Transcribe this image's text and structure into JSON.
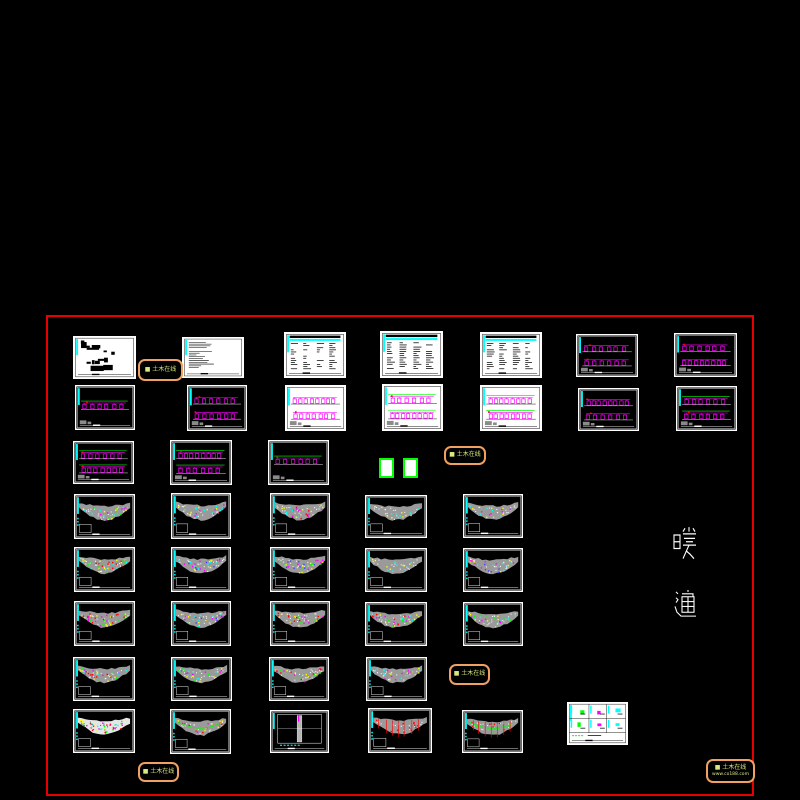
{
  "canvas": {
    "background_color": "#000000",
    "frame": {
      "x": 46,
      "y": 315,
      "w": 708,
      "h": 481,
      "color": "#e60000"
    },
    "hvac_label": {
      "text": "暖通",
      "chars": [
        {
          "ch": "暖",
          "x": 673,
          "y": 526,
          "w": 24,
          "h": 36
        },
        {
          "ch": "通",
          "x": 673,
          "y": 589,
          "w": 24,
          "h": 31
        }
      ],
      "color": "#ffffff"
    },
    "watermarks": [
      {
        "x": 138,
        "y": 359,
        "w": 45,
        "h": 22,
        "lines": [
          "■ 土木在线"
        ]
      },
      {
        "x": 444,
        "y": 446,
        "w": 42,
        "h": 19,
        "lines": [
          "■ 土木在线"
        ]
      },
      {
        "x": 449,
        "y": 664,
        "w": 41,
        "h": 21,
        "lines": [
          "■ 土木在线"
        ]
      },
      {
        "x": 138,
        "y": 762,
        "w": 41,
        "h": 20,
        "lines": [
          "■ 土木在线"
        ]
      },
      {
        "x": 706,
        "y": 759,
        "w": 49,
        "h": 24,
        "lines": [
          "■ 土木在线",
          "www.co188.com"
        ]
      }
    ],
    "green_boxes": [
      {
        "x": 379,
        "y": 458,
        "w": 15,
        "h": 20
      },
      {
        "x": 403,
        "y": 458,
        "w": 15,
        "h": 20
      }
    ],
    "palette": {
      "cyan": "#00ffff",
      "magenta": "#ff00ff",
      "green": "#00ff00",
      "yellow": "#ffff00",
      "red": "#ff0000",
      "blue": "#4040ff",
      "white": "#ffffff",
      "gray_building": "#9a9a9a",
      "stamp_text": "#d9e87f",
      "stamp_border": "#f0a060"
    },
    "sheets": [
      {
        "id": "r1c1",
        "x": 73,
        "y": 336,
        "w": 63,
        "h": 43,
        "kind": "cover",
        "bg": "white",
        "accents": []
      },
      {
        "id": "r1c2",
        "x": 182,
        "y": 337,
        "w": 62,
        "h": 41,
        "kind": "notes",
        "bg": "white",
        "accents": []
      },
      {
        "id": "r1c3",
        "x": 284,
        "y": 332,
        "w": 62,
        "h": 46,
        "kind": "table",
        "bg": "white",
        "accents": []
      },
      {
        "id": "r1c4",
        "x": 380,
        "y": 331,
        "w": 63,
        "h": 47,
        "kind": "table",
        "bg": "white",
        "accents": []
      },
      {
        "id": "r1c5",
        "x": 480,
        "y": 332,
        "w": 62,
        "h": 46,
        "kind": "table",
        "bg": "white",
        "accents": []
      },
      {
        "id": "r1c6",
        "x": 576,
        "y": 334,
        "w": 62,
        "h": 43,
        "kind": "system",
        "bg": "black",
        "accents": [
          "#ff00ff"
        ],
        "bands": 2
      },
      {
        "id": "r1c7",
        "x": 674,
        "y": 333,
        "w": 63,
        "h": 44,
        "kind": "system",
        "bg": "black",
        "accents": [
          "#ff00ff"
        ],
        "bands": 2
      },
      {
        "id": "r2c1",
        "x": 75,
        "y": 385,
        "w": 60,
        "h": 45,
        "kind": "system",
        "bg": "black",
        "accents": [
          "#ff00ff",
          "#00ff00"
        ],
        "bands": 1
      },
      {
        "id": "r2c2",
        "x": 187,
        "y": 385,
        "w": 60,
        "h": 46,
        "kind": "system",
        "bg": "black",
        "accents": [
          "#ff00ff"
        ],
        "bands": 2
      },
      {
        "id": "r2c3",
        "x": 285,
        "y": 385,
        "w": 61,
        "h": 46,
        "kind": "system",
        "bg": "white",
        "accents": [
          "#ff00ff"
        ],
        "bands": 2
      },
      {
        "id": "r2c4",
        "x": 382,
        "y": 384,
        "w": 61,
        "h": 47,
        "kind": "system",
        "bg": "white",
        "accents": [
          "#ff00ff",
          "#00ff00"
        ],
        "bands": 2
      },
      {
        "id": "r2c5",
        "x": 480,
        "y": 385,
        "w": 62,
        "h": 46,
        "kind": "system",
        "bg": "white",
        "accents": [
          "#ff00ff",
          "#00ff00"
        ],
        "bands": 2
      },
      {
        "id": "r2c6",
        "x": 578,
        "y": 388,
        "w": 61,
        "h": 43,
        "kind": "system",
        "bg": "black",
        "accents": [
          "#ff00ff"
        ],
        "bands": 2
      },
      {
        "id": "r2c7",
        "x": 676,
        "y": 386,
        "w": 61,
        "h": 45,
        "kind": "system",
        "bg": "black",
        "accents": [
          "#ff00ff",
          "#00ff00"
        ],
        "bands": 2
      },
      {
        "id": "r3c1",
        "x": 73,
        "y": 441,
        "w": 61,
        "h": 43,
        "kind": "system",
        "bg": "black",
        "accents": [
          "#ff00ff",
          "#00ff00"
        ],
        "bands": 2
      },
      {
        "id": "r3c2",
        "x": 170,
        "y": 440,
        "w": 62,
        "h": 45,
        "kind": "system",
        "bg": "black",
        "accents": [
          "#ff00ff",
          "#00ff00"
        ],
        "bands": 2
      },
      {
        "id": "r3c3",
        "x": 268,
        "y": 440,
        "w": 61,
        "h": 45,
        "kind": "system",
        "bg": "black",
        "accents": [
          "#ff00ff",
          "#00ff00"
        ],
        "bands": 1
      },
      {
        "id": "r4c1",
        "x": 74,
        "y": 494,
        "w": 61,
        "h": 45,
        "kind": "plan",
        "bg": "black",
        "accents": [
          "#00ffff",
          "#ffff00",
          "#ff00ff",
          "#00ff00"
        ],
        "density": 30
      },
      {
        "id": "r4c2",
        "x": 171,
        "y": 493,
        "w": 60,
        "h": 46,
        "kind": "plan",
        "bg": "black",
        "accents": [
          "#00ffff",
          "#ff00ff",
          "#ffff00"
        ],
        "density": 25
      },
      {
        "id": "r4c3",
        "x": 270,
        "y": 493,
        "w": 60,
        "h": 46,
        "kind": "plan",
        "bg": "black",
        "accents": [
          "#ff00ff",
          "#ffff00",
          "#ff0000",
          "#00ffff"
        ],
        "density": 30
      },
      {
        "id": "r4c4",
        "x": 365,
        "y": 495,
        "w": 62,
        "h": 43,
        "kind": "plan",
        "bg": "black",
        "accents": [
          "#00ffff",
          "#ffff00"
        ],
        "density": 14
      },
      {
        "id": "r4c5",
        "x": 463,
        "y": 494,
        "w": 60,
        "h": 44,
        "kind": "plan",
        "bg": "black",
        "accents": [
          "#00ffff",
          "#ffff00",
          "#ff00ff"
        ],
        "density": 18
      },
      {
        "id": "r5c1",
        "x": 74,
        "y": 547,
        "w": 61,
        "h": 45,
        "kind": "plan",
        "bg": "black",
        "accents": [
          "#ffff00",
          "#00ff00",
          "#ff0000",
          "#00ffff"
        ],
        "density": 42
      },
      {
        "id": "r5c2",
        "x": 171,
        "y": 547,
        "w": 60,
        "h": 45,
        "kind": "plan",
        "bg": "black",
        "accents": [
          "#ff00ff",
          "#00ffff",
          "#ffff00",
          "#4040ff"
        ],
        "density": 30
      },
      {
        "id": "r5c3",
        "x": 270,
        "y": 547,
        "w": 60,
        "h": 45,
        "kind": "plan",
        "bg": "black",
        "accents": [
          "#ffff00",
          "#00ff00",
          "#ff00ff",
          "#4040ff"
        ],
        "density": 36
      },
      {
        "id": "r5c4",
        "x": 365,
        "y": 548,
        "w": 62,
        "h": 44,
        "kind": "plan",
        "bg": "black",
        "accents": [
          "#00ffff",
          "#ffff00"
        ],
        "density": 14
      },
      {
        "id": "r5c5",
        "x": 463,
        "y": 548,
        "w": 60,
        "h": 44,
        "kind": "plan",
        "bg": "black",
        "accents": [
          "#ff00ff",
          "#00ffff",
          "#4040ff",
          "#ffff00"
        ],
        "density": 26
      },
      {
        "id": "r6c1",
        "x": 74,
        "y": 601,
        "w": 61,
        "h": 45,
        "kind": "plan",
        "bg": "black",
        "accents": [
          "#ffff00",
          "#ff0000",
          "#00ff00",
          "#ff00ff"
        ],
        "density": 42
      },
      {
        "id": "r6c2",
        "x": 171,
        "y": 601,
        "w": 60,
        "h": 45,
        "kind": "plan",
        "bg": "black",
        "accents": [
          "#00ffff",
          "#ff00ff",
          "#ffff00",
          "#4040ff"
        ],
        "density": 30
      },
      {
        "id": "r6c3",
        "x": 270,
        "y": 601,
        "w": 60,
        "h": 45,
        "kind": "plan",
        "bg": "black",
        "accents": [
          "#ffff00",
          "#ff00ff",
          "#00ff00",
          "#ff0000"
        ],
        "density": 36
      },
      {
        "id": "r6c4",
        "x": 365,
        "y": 602,
        "w": 62,
        "h": 44,
        "kind": "plan",
        "bg": "black",
        "accents": [
          "#ffff00",
          "#ff00ff",
          "#00ff00",
          "#00ffff",
          "#ff0000"
        ],
        "density": 40
      },
      {
        "id": "r6c5",
        "x": 463,
        "y": 602,
        "w": 60,
        "h": 44,
        "kind": "plan",
        "bg": "black",
        "accents": [
          "#ff00ff",
          "#00ff00",
          "#ffff00",
          "#00ffff"
        ],
        "density": 30
      },
      {
        "id": "r7c1",
        "x": 73,
        "y": 657,
        "w": 62,
        "h": 44,
        "kind": "plan",
        "bg": "black",
        "accents": [
          "#ffff00",
          "#ff0000",
          "#00ffff",
          "#ff00ff",
          "#00ff00"
        ],
        "density": 36
      },
      {
        "id": "r7c2",
        "x": 171,
        "y": 657,
        "w": 61,
        "h": 44,
        "kind": "plan",
        "bg": "black",
        "accents": [
          "#ff00ff",
          "#ffff00",
          "#00ffff",
          "#00ff00"
        ],
        "density": 30
      },
      {
        "id": "r7c3",
        "x": 269,
        "y": 657,
        "w": 60,
        "h": 44,
        "kind": "plan",
        "bg": "black",
        "accents": [
          "#ffff00",
          "#ff00ff",
          "#00ff00",
          "#ff0000"
        ],
        "density": 30
      },
      {
        "id": "r7c4",
        "x": 366,
        "y": 657,
        "w": 61,
        "h": 44,
        "kind": "plan",
        "bg": "black",
        "accents": [
          "#00ffff",
          "#ff00ff",
          "#ffff00"
        ],
        "density": 25
      },
      {
        "id": "r8c1",
        "x": 73,
        "y": 709,
        "w": 62,
        "h": 44,
        "kind": "plan",
        "bg": "black",
        "variant": "whiteband",
        "accents": [
          "#00ff00",
          "#ffff00",
          "#ff00ff",
          "#00ffff",
          "#ff0000"
        ],
        "density": 48
      },
      {
        "id": "r8c2",
        "x": 170,
        "y": 709,
        "w": 61,
        "h": 45,
        "kind": "plan",
        "bg": "black",
        "variant": "greenline",
        "accents": [
          "#ff0000",
          "#ffff00",
          "#ff00ff"
        ],
        "density": 20
      },
      {
        "id": "r8c3",
        "x": 270,
        "y": 710,
        "w": 59,
        "h": 43,
        "kind": "section",
        "bg": "black",
        "accents": [
          "#ff00ff",
          "#00ffff"
        ]
      },
      {
        "id": "r8c4",
        "x": 368,
        "y": 708,
        "w": 64,
        "h": 45,
        "kind": "plan",
        "bg": "black",
        "variant": "redlines",
        "accents": [
          "#ff0000"
        ],
        "density": 12
      },
      {
        "id": "r8c5",
        "x": 462,
        "y": 710,
        "w": 61,
        "h": 43,
        "kind": "plan",
        "bg": "black",
        "variant": "redlines-green",
        "accents": [
          "#ff0000",
          "#00ff00"
        ],
        "density": 14
      },
      {
        "id": "r8c6",
        "x": 567,
        "y": 702,
        "w": 61,
        "h": 43,
        "kind": "detail",
        "bg": "white",
        "accents": [
          "#00ff00",
          "#ff00ff",
          "#00ffff"
        ]
      }
    ]
  }
}
